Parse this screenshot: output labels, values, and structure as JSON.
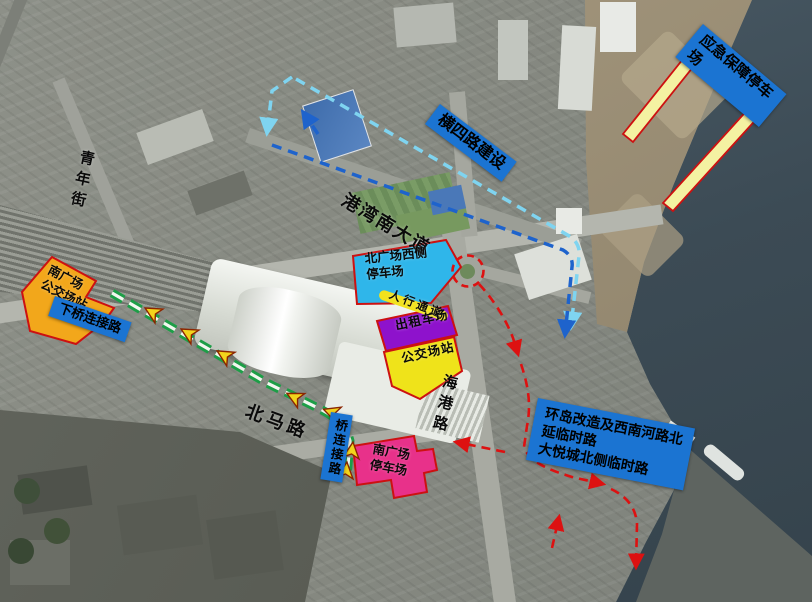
{
  "map": {
    "road_names": {
      "qingnian_street": "青年街",
      "gangwan_south_avenue": "港湾南大道",
      "haigang_road": "海港路",
      "beima_road": "北马路"
    },
    "zone_labels": {
      "emergency_parking": "应急保障停车场",
      "hengsi_road_construction": "横四路建设",
      "north_square_west_parking": "北广场西侧\n停车场",
      "pedestrian_corridor": "人行通道",
      "south_square_bus_terminal": "南广场\n公交场站",
      "down_bridge_link_road": "下桥连接路",
      "taxi_area": "出租车场",
      "bus_terminal": "公交场站",
      "bridge_link_road": "桥连接路",
      "south_square_parking": "南广场\n停车场",
      "temp_road_note": "环岛改造及西南河路北\n延临时路\n大悦城北侧临时路"
    },
    "colors": {
      "label_blue": "#1b74d2",
      "zone_orange": "#f2a71b",
      "zone_purple": "#8e12cc",
      "zone_yellow": "#efe31a",
      "zone_pink": "#e8318a",
      "zone_lightblue": "#2fb6ea",
      "zone_border_red": "#cc1111",
      "strip_yellow": "#f4f2a2",
      "route_red": "#dd1111",
      "route_green": "#1d9e47",
      "route_lightblue": "#7fd4f0",
      "route_blue": "#1e63cc",
      "arrow_yellow": "#f2d41c"
    }
  }
}
